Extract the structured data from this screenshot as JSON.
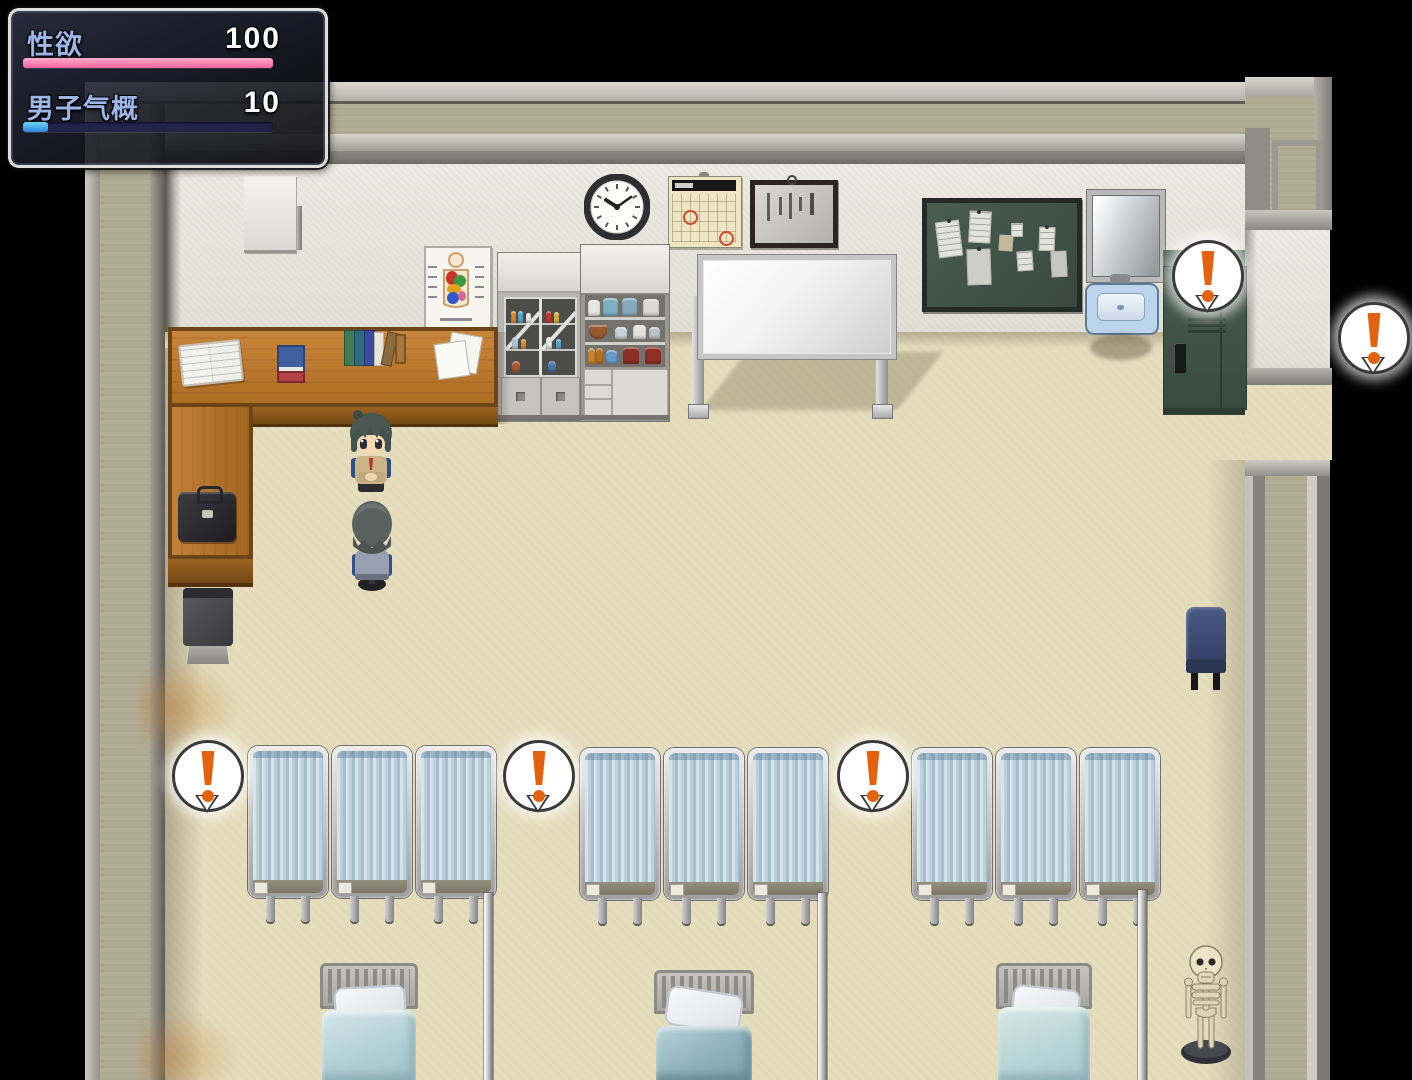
{
  "status_window": {
    "label_color": "#9cb6ea",
    "value_color": "#ffffff",
    "stats": [
      {
        "label": "性欲",
        "value": "100",
        "percent": 100,
        "fill_top": "#fbaecb",
        "fill_bottom": "#f4619f",
        "track": "#23224a"
      },
      {
        "label": "男子气概",
        "value": "10",
        "percent": 10,
        "fill_top": "#6fd2f8",
        "fill_bottom": "#2b86e0",
        "track": "#23224a"
      }
    ]
  },
  "event_markers": {
    "glyph": "!",
    "color": "#e2620f",
    "count": 5
  }
}
